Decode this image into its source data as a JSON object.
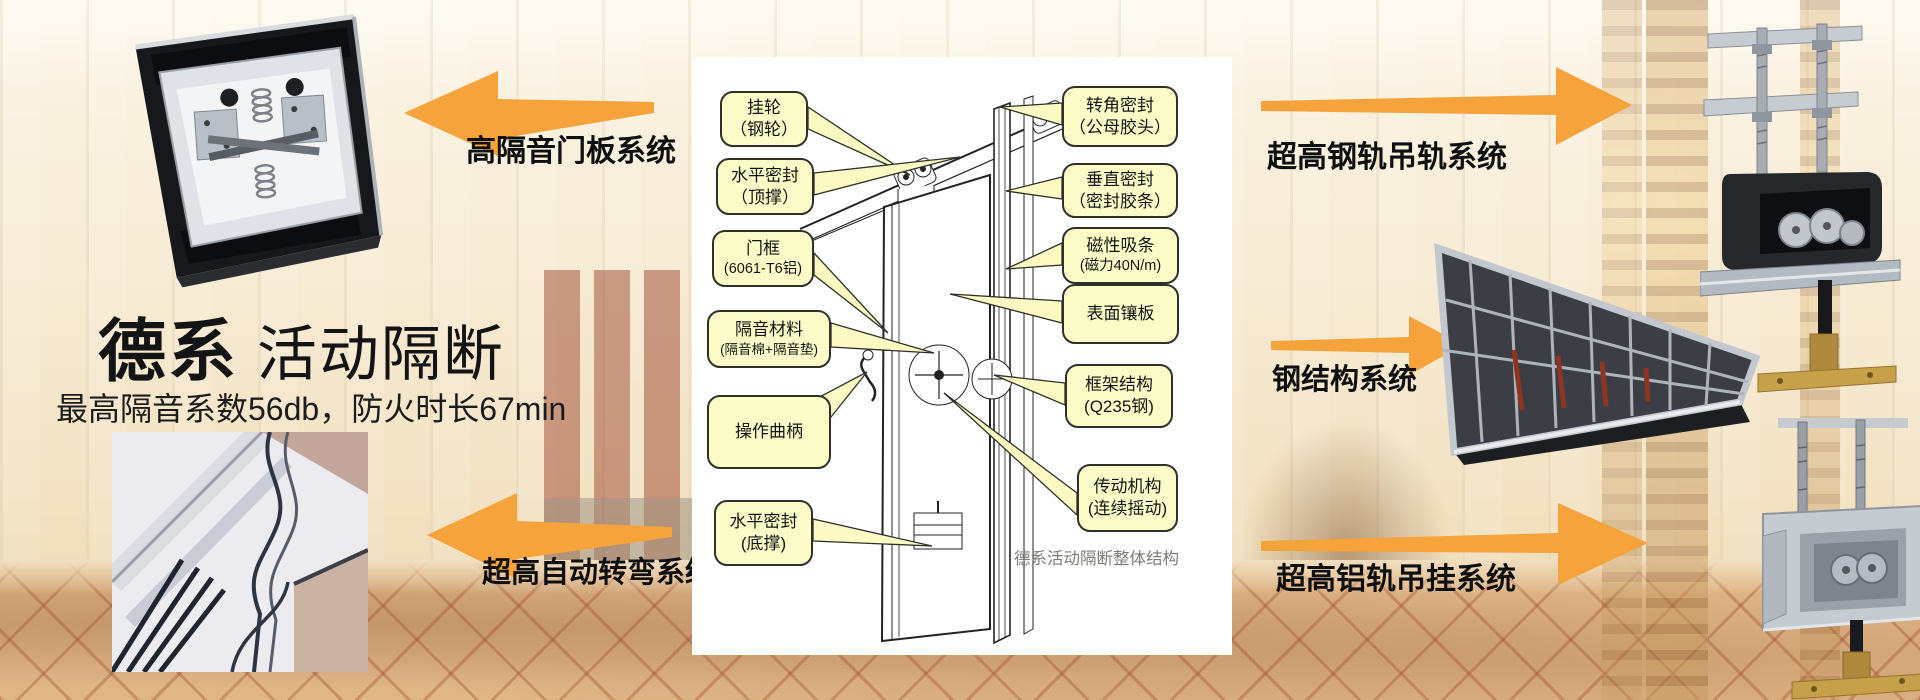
{
  "brand": {
    "title_bold": "德系",
    "title_regular": "活动隔断",
    "subtitle": "最高隔音系数56db，防火时长67min"
  },
  "system_labels": {
    "top_left": "高隔音门板系统",
    "bottom_left": "超高自动转弯系统",
    "top_right": "超高钢轨吊轨系统",
    "middle_right": "钢结构系统",
    "bottom_right": "超高铝轨吊挂系统"
  },
  "diagram": {
    "caption": "德系活动隔断整体结构",
    "labels_left": [
      {
        "line1": "挂轮",
        "line2": "（钢轮）"
      },
      {
        "line1": "水平密封",
        "line2": "（顶撑）"
      },
      {
        "line1": "门框",
        "line2": "(6061-T6铝)"
      },
      {
        "line1": "隔音材料",
        "line2": "(隔音棉+隔音垫)"
      },
      {
        "line1": "操作曲柄",
        "line2": ""
      },
      {
        "line1": "水平密封",
        "line2": "(底撑)"
      }
    ],
    "labels_right": [
      {
        "line1": "转角密封",
        "line2": "（公母胶头）"
      },
      {
        "line1": "垂直密封",
        "line2": "（密封胶条）"
      },
      {
        "line1": "磁性吸条",
        "line2": "(磁力40N/m)"
      },
      {
        "line1": "表面镶板",
        "line2": ""
      },
      {
        "line1": "框架结构",
        "line2": "(Q235钢)"
      },
      {
        "line1": "传动机构",
        "line2": "(连续摇动)"
      }
    ]
  },
  "photos": {
    "top_left": "door-panel-top-mechanism-photo",
    "bottom_left": "curved-track-photo",
    "top_right": "steel-rail-trolley-photo",
    "middle_right": "steel-frame-structure-photo",
    "bottom_right": "aluminum-rail-trolley-photo"
  },
  "colors": {
    "arrow_orange": "#F6A33C",
    "callout_bg": "#FCFCC8",
    "callout_border": "#30302A",
    "caption_gray": "#7C7C78"
  }
}
